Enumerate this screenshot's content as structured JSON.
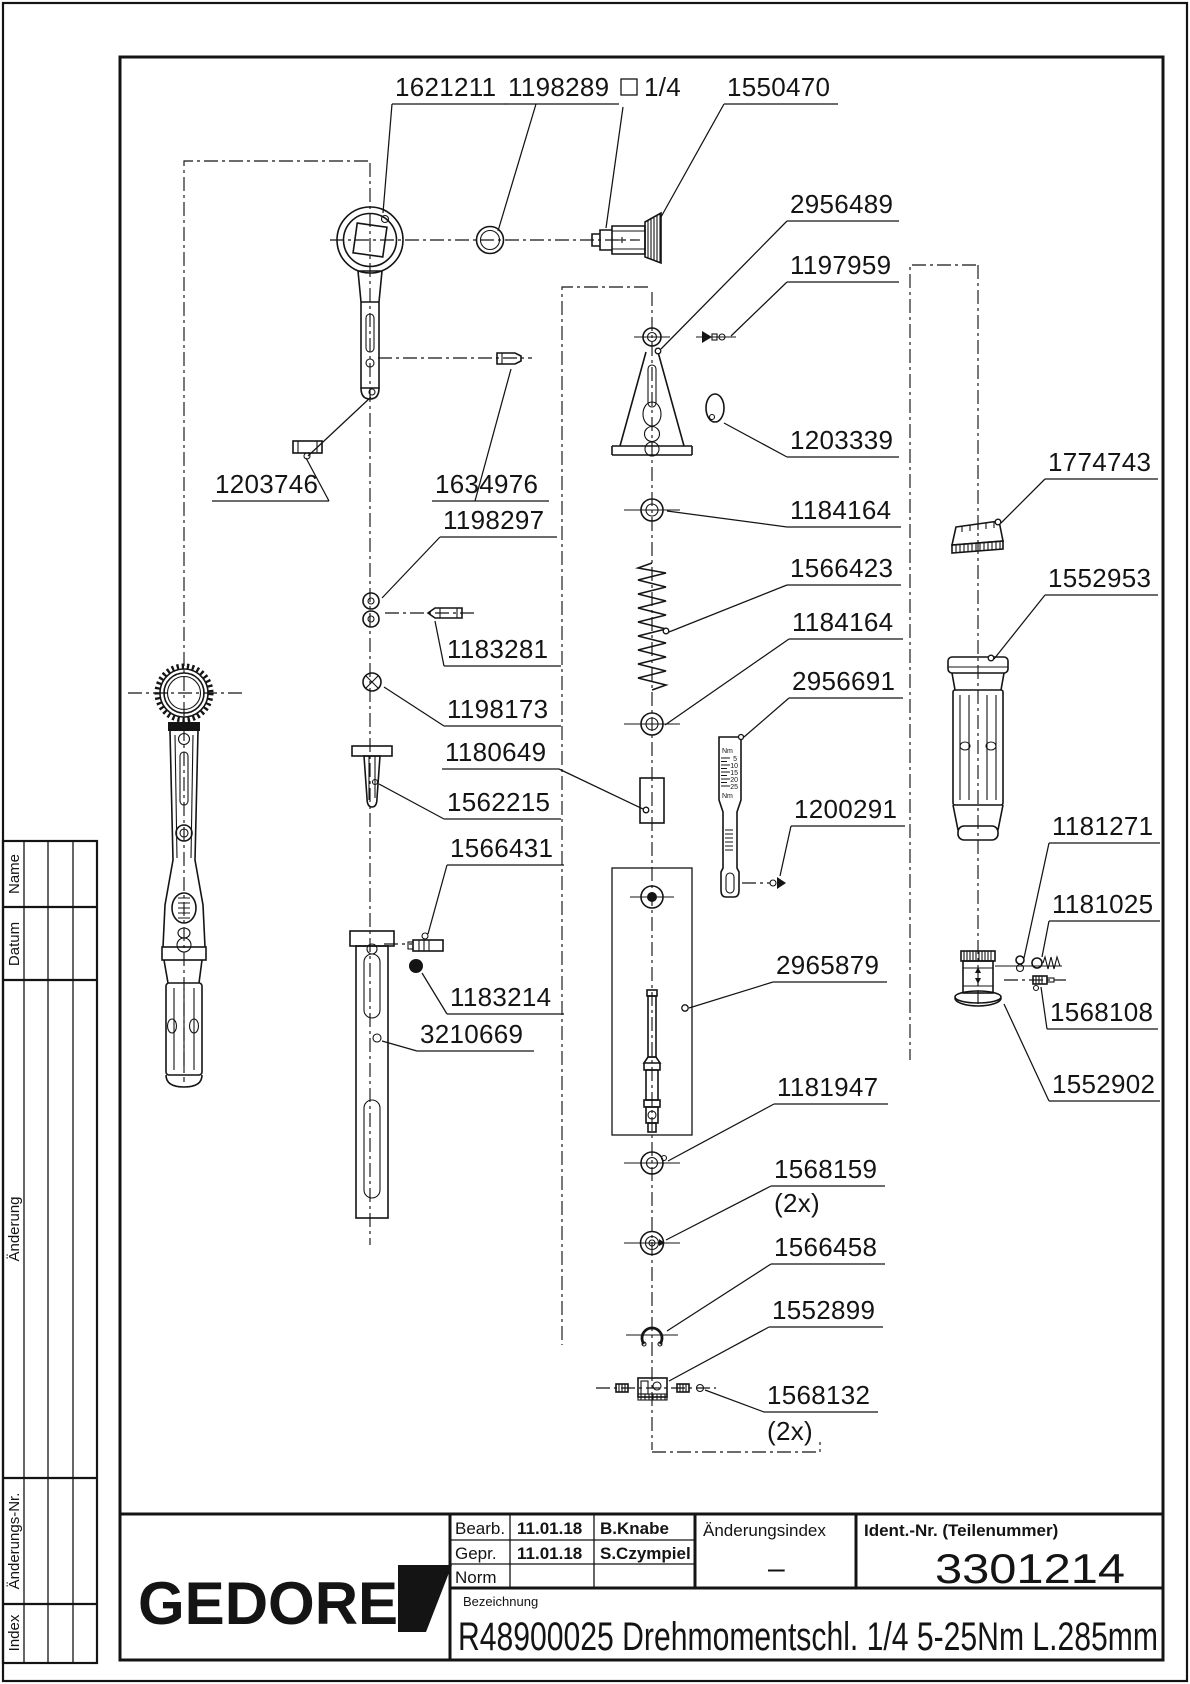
{
  "colors": {
    "ink": "#141414",
    "paper": "#ffffff"
  },
  "titleblock": {
    "logo": "GEDORE",
    "bearb_label": "Bearb.",
    "bearb_date": "11.01.18",
    "bearb_name": "B.Knabe",
    "gepr_label": "Gepr.",
    "gepr_date": "11.01.18",
    "gepr_name": "S.Czympiel",
    "norm_label": "Norm",
    "aenderungsindex_label": "Änderungsindex",
    "aenderungsindex_value": "–",
    "ident_label": "Ident.-Nr.  (Teilenummer)",
    "ident_value": "3301214",
    "bezeichnung_label": "Bezeichnung",
    "bezeichnung_value": "R48900025 Drehmomentschl. 1/4 5-25Nm L.285mm"
  },
  "revision_strip": {
    "name": "Name",
    "datum": "Datum",
    "aenderung": "Änderung",
    "aenderungs_nr": "Änderungs-Nr.",
    "index": "Index"
  },
  "scale_part": {
    "unit_top": "Nm",
    "unit_bottom": "Nm",
    "ticks": [
      "5",
      "10",
      "15",
      "20",
      "25"
    ]
  },
  "labels": [
    {
      "text": "1621211"
    },
    {
      "text": "1198289"
    },
    {
      "text": "1/4",
      "symbol": "square"
    },
    {
      "text": "1550470"
    },
    {
      "text": "2956489"
    },
    {
      "text": "1197959"
    },
    {
      "text": "1203339"
    },
    {
      "text": "1774743"
    },
    {
      "text": "1552953"
    },
    {
      "text": "1203746"
    },
    {
      "text": "1634976"
    },
    {
      "text": "1198297"
    },
    {
      "text": "1183281"
    },
    {
      "text": "1198173"
    },
    {
      "text": "1180649"
    },
    {
      "text": "1562215"
    },
    {
      "text": "1566431"
    },
    {
      "text": "1183214"
    },
    {
      "text": "3210669"
    },
    {
      "text": "1184164"
    },
    {
      "text": "1566423"
    },
    {
      "text": "1184164"
    },
    {
      "text": "2956691"
    },
    {
      "text": "1200291"
    },
    {
      "text": "2965879"
    },
    {
      "text": "1181947"
    },
    {
      "text": "1568159",
      "sub": "(2x)"
    },
    {
      "text": "1566458"
    },
    {
      "text": "1552899"
    },
    {
      "text": "1568132",
      "sub": "(2x)"
    },
    {
      "text": "1181271"
    },
    {
      "text": "1181025"
    },
    {
      "text": "1568108"
    },
    {
      "text": "1552902"
    }
  ]
}
